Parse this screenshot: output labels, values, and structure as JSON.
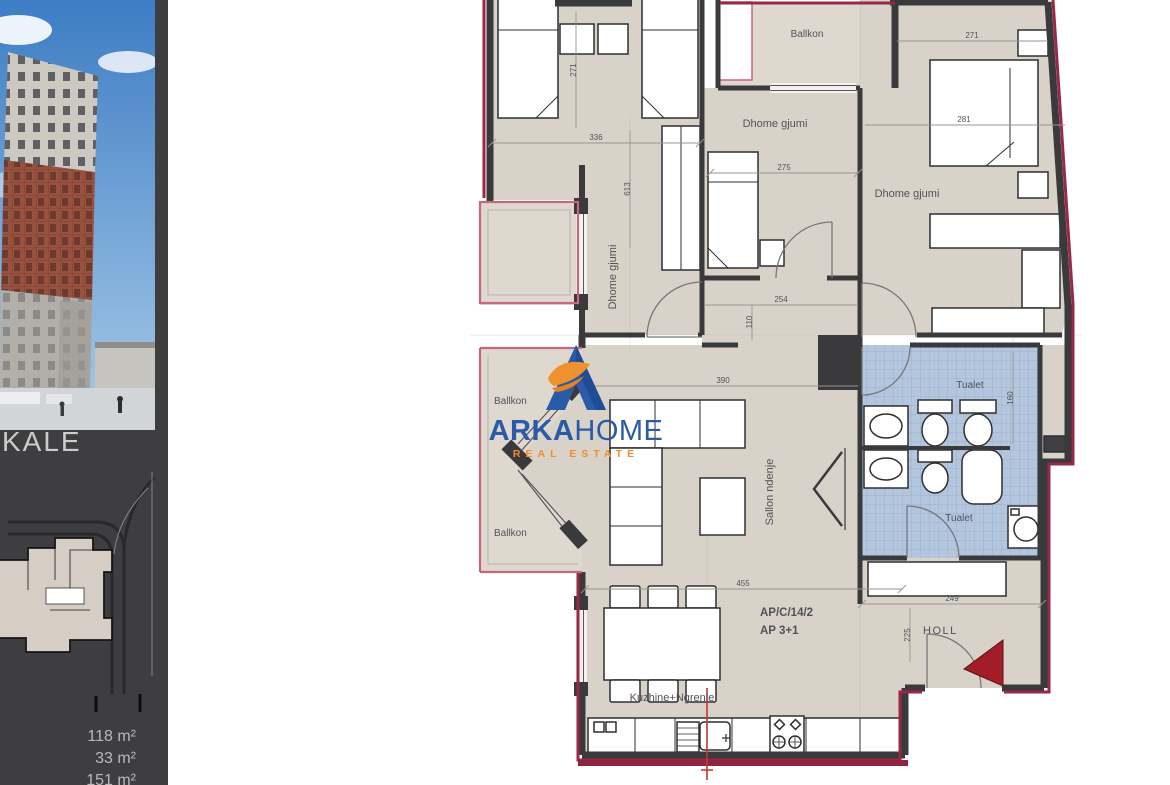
{
  "sidebar": {
    "project_label": "KALE",
    "areas": [
      "118 m²",
      "33 m²",
      "151 m²"
    ]
  },
  "watermark": {
    "brand_primary": "ARKA",
    "brand_secondary": "HOME",
    "tagline": "REAL ESTATE",
    "colors": {
      "blue": "#2a5ba8",
      "orange": "#f0912f"
    }
  },
  "floorplan": {
    "code_line1": "AP/C/14/2",
    "code_line2": "AP 3+1",
    "labels": {
      "balcony_top": "Ballkon",
      "bedroom_middle": "Dhome gjumi",
      "bedroom_right": "Dhome gjumi",
      "bedroom_left": "Dhome gjumi",
      "balcony_left_upper": "Ballkon",
      "balcony_left_lower": "Ballkon",
      "living_room": "Sallon ndenje",
      "toilet_upper": "Tualet",
      "toilet_lower": "Tualet",
      "hall": "HOLL",
      "kitchen_dining": "Kuzhine+Ngrenie"
    },
    "dimensions": {
      "bed1_width": "271",
      "bed1_room_width": "336",
      "bed1_room_height": "613",
      "bed2_room_width": "275",
      "corridor_width": "254",
      "bed3_room_width": "271",
      "bed3_bed_width": "281",
      "living_width": "390",
      "corridor_small": "110",
      "kitchen_width": "455",
      "hall_width": "249",
      "hall_height": "225",
      "bath_height": "160"
    },
    "accent_colors": {
      "wall_red": "#9b2746",
      "code_red": "#d84c4c",
      "tile_blue": "#b3c6dd"
    }
  }
}
